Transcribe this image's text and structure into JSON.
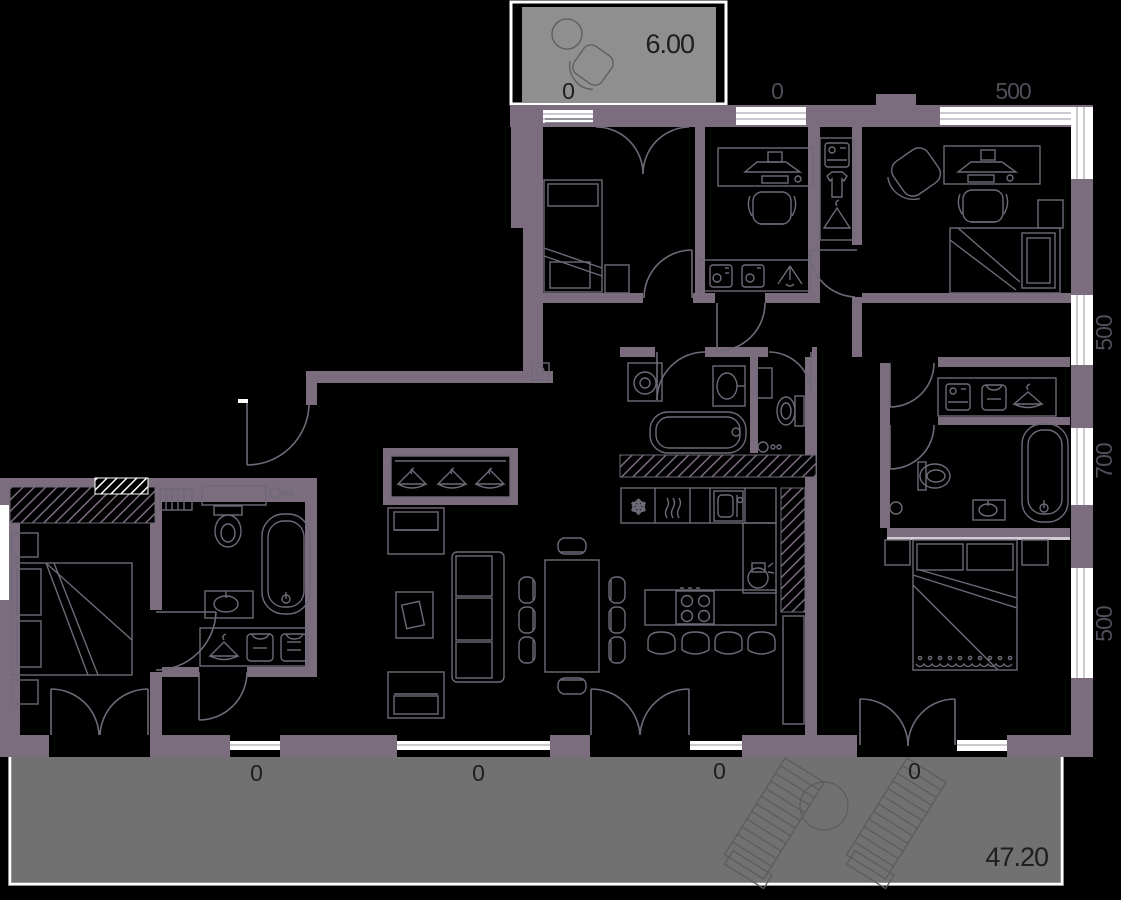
{
  "title": "apartment-floor-plan",
  "colors": {
    "background": "#000000",
    "wall": "#7b6c7e",
    "terrace_fill": "#717171",
    "balcony_fill": "#8f8f8f",
    "furniture_line": "#6e6a78",
    "window_fill": "#ffffff",
    "dim_text": "#514d59",
    "dark_text": "#1e1e1e"
  },
  "labels": {
    "balcony_area": "6.00",
    "balcony_zero": "0",
    "top_zero": "0",
    "top_500": "500",
    "right_500_upper": "500",
    "right_700": "700",
    "right_500_lower": "500",
    "terrace_area": "47.20",
    "terrace_zeros": [
      "0",
      "0",
      "0",
      "0"
    ]
  },
  "icons": {
    "snowflake": "❄"
  },
  "rooms": {
    "balcony": {
      "furniture": [
        "round-table",
        "lounge-chair"
      ]
    },
    "bedroom_top_left": {
      "furniture": [
        "single-bed",
        "side-cabinet",
        "balcony-french-door"
      ]
    },
    "office_room": {
      "furniture": [
        "desk",
        "monitor",
        "keyboard",
        "office-chair",
        "shelf-with-pc-towers",
        "tripod"
      ]
    },
    "hall_wardrobe": {
      "furniture": [
        "appliance",
        "shirt",
        "hanger"
      ]
    },
    "bedroom_top_right": {
      "furniture": [
        "armchair",
        "desk",
        "monitor",
        "office-chair",
        "bed",
        "nightstand"
      ]
    },
    "bathroom_center": {
      "furniture": [
        "washing-machine",
        "sink",
        "bathtub",
        "shelf"
      ]
    },
    "wc_center": {
      "furniture": [
        "toilet",
        "faucet",
        "shelf"
      ]
    },
    "kitchen": {
      "furniture": [
        "fridge",
        "oven",
        "sink",
        "coffee-machine",
        "island-stove",
        "bar-stools"
      ]
    },
    "living_room": {
      "furniture": [
        "coat-rack",
        "armchair",
        "armchair",
        "coffee-table",
        "sofa",
        "dining-table",
        "dining-chairs"
      ]
    },
    "entry_hall": {
      "furniture": [
        "intercom",
        "entry-door"
      ]
    },
    "bedroom_left": {
      "furniture": [
        "double-bed",
        "nightstands",
        "wardrobe-hatched",
        "radiator",
        "terrace-french-door"
      ]
    },
    "bathroom_left": {
      "furniture": [
        "vanity",
        "toilet",
        "bathtub",
        "sink",
        "hanger-shelf",
        "towels"
      ]
    },
    "bathroom_right": {
      "furniture": [
        "shelf-niche",
        "toilet",
        "bathtub",
        "sink"
      ]
    },
    "master_bedroom": {
      "furniture": [
        "double-bed",
        "nightstands",
        "cabinet",
        "terrace-french-door"
      ]
    },
    "terrace": {
      "furniture": [
        "sun-lounger",
        "sun-lounger",
        "round-table"
      ]
    }
  }
}
